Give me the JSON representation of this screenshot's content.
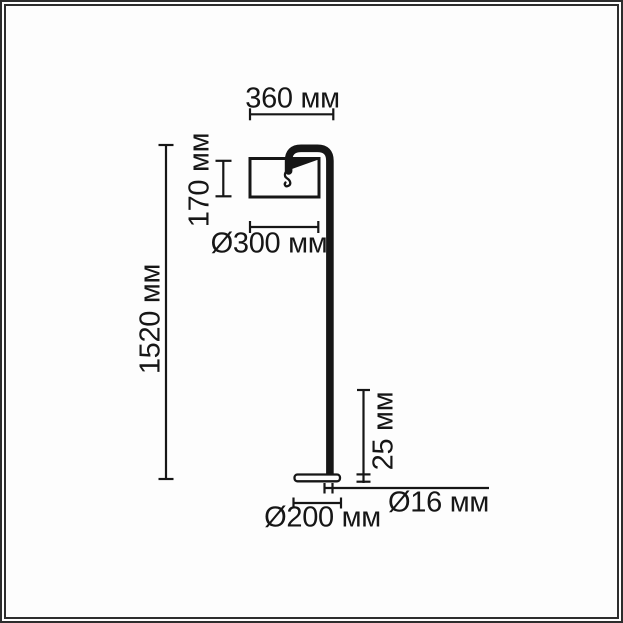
{
  "page": {
    "background": "#ffffff",
    "frame_color": "#2d2d2d",
    "ink_color": "#161616"
  },
  "diagram": {
    "kind": "floor-lamp dimension drawing",
    "unit": "мм",
    "dimensions": [
      {
        "id": "arm-reach",
        "label": "360 мм",
        "value": 360,
        "orientation": "horizontal"
      },
      {
        "id": "shade-height",
        "label": "170 мм",
        "value": 170,
        "orientation": "vertical"
      },
      {
        "id": "shade-diameter",
        "label": "Ø300 мм",
        "value": 300,
        "orientation": "horizontal"
      },
      {
        "id": "total-height",
        "label": "1520 мм",
        "value": 1520,
        "orientation": "vertical"
      },
      {
        "id": "base-height",
        "label": "25 мм",
        "value": 25,
        "orientation": "vertical"
      },
      {
        "id": "pole-diameter",
        "label": "Ø16 мм",
        "value": 16,
        "orientation": "horizontal"
      },
      {
        "id": "base-diameter",
        "label": "Ø200 мм",
        "value": 200,
        "orientation": "horizontal"
      }
    ]
  }
}
